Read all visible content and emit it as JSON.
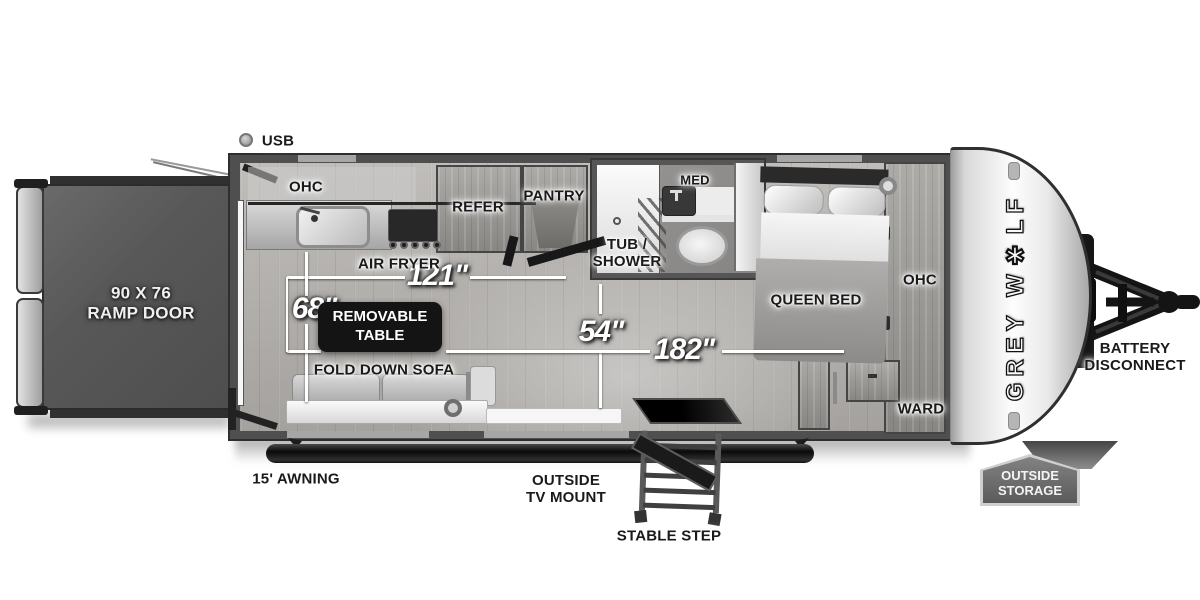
{
  "floorplan": {
    "labels": {
      "usb": "USB",
      "ohc_kitchen": "OHC",
      "refer": "REFER",
      "pantry": "PANTRY",
      "air_fryer": "AIR FRYER",
      "tub_shower": "TUB /\nSHOWER",
      "med": "MED",
      "queen_bed": "QUEEN BED",
      "ohc_bedroom": "OHC",
      "ward": "WARD",
      "ramp_door": "90 X 76\nRAMP DOOR",
      "removable_table": "REMOVABLE\nTABLE",
      "fold_down_sofa": "FOLD DOWN SOFA",
      "awning": "15' AWNING",
      "outside_tv_mount": "OUTSIDE\nTV MOUNT",
      "stable_step": "STABLE STEP",
      "battery_disconnect": "BATTERY\nDISCONNECT",
      "outside_storage": "OUTSIDE\nSTORAGE",
      "brand_logo": "GREY W✱LF"
    },
    "dimensions": {
      "galley_width": "121\"",
      "sofa_length": "68\"",
      "aisle_width": "54\"",
      "interior_length": "182\""
    },
    "colors": {
      "wall": "#4f4f4f",
      "ramp_door": "#575757",
      "callout_bg": "#141414",
      "dimension_text": "#ffffff",
      "floor": "#b7b4b0"
    }
  }
}
